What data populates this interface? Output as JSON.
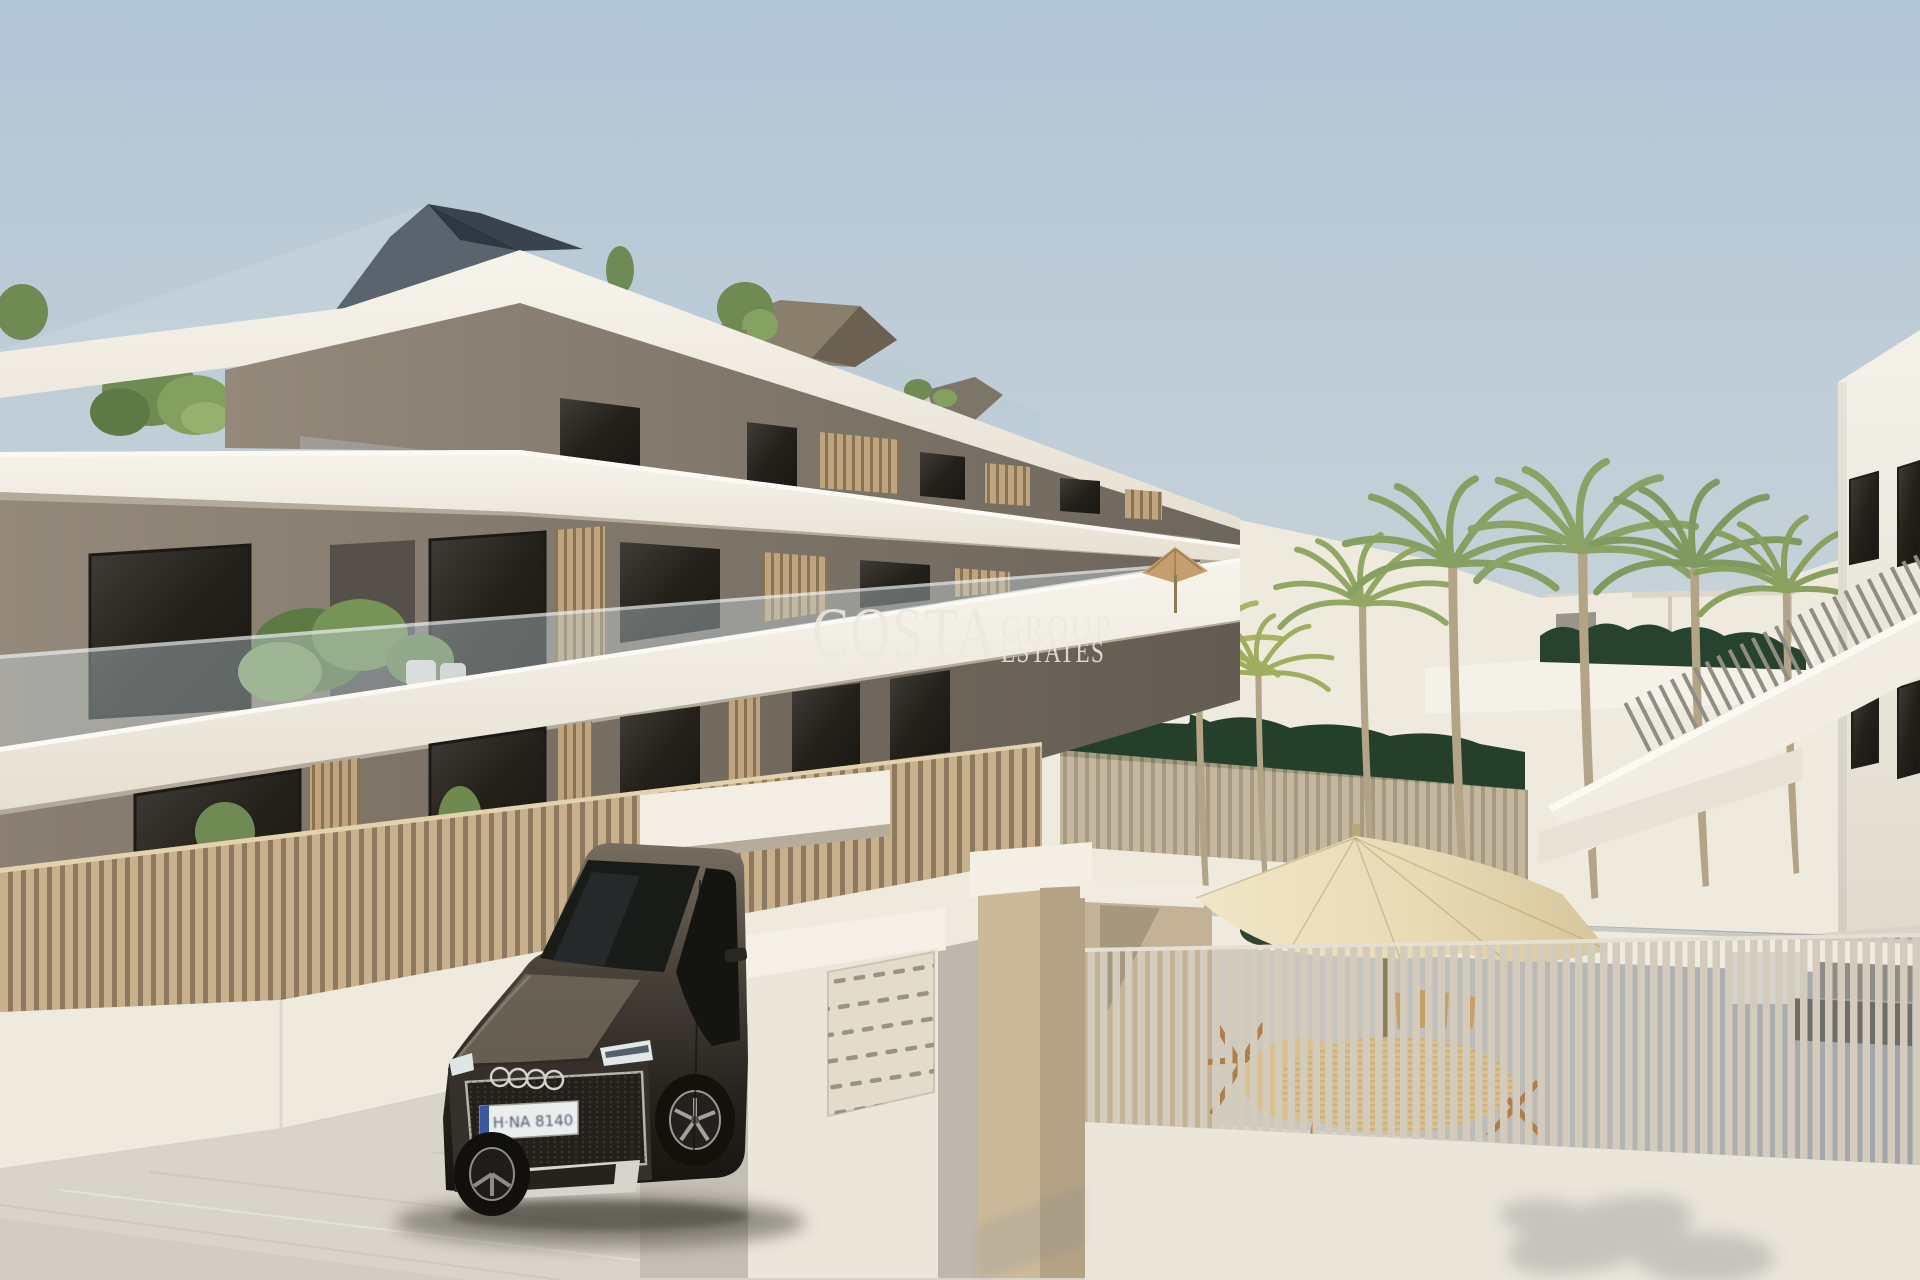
{
  "scene": {
    "type": "architectural-3d-render",
    "description": "Exterior render of a new-build three-storey apartment building with roof terraces, wooden louvre balcony screens, slatted fences, entrance gate with mailbox wall, dark SUV parked at the driveway, pool terrace with palm trees, parasols and outdoor furniture, and a white side building with an external staircase.",
    "building_floors": "3",
    "time_of_day": "daylight"
  },
  "watermark": {
    "brand": "COSTA",
    "line1": "GROUP",
    "line2": "ESTATES"
  },
  "vehicle": {
    "make_hint": "audi-rings-grille",
    "license_plate": "H·NA 8140"
  },
  "palette": {
    "sky_top": "#b2c5d5",
    "sky_horizon": "#e7e4d8",
    "slab_white": "#f4f0e6",
    "soffit": "#b3aa9a",
    "facade_light": "#94897b",
    "facade_dark": "#6e665c",
    "window_dark": "#2c2a26",
    "glass_tint": "#c3d2d8",
    "louvre": "#bfa57f",
    "fence_tan": "#c8b08c",
    "fence_tan_gap": "#8d7a5e",
    "fence_grey": "#d3cbbc",
    "wall_white": "#ebe6da",
    "wall_beige": "#c6b496",
    "pavement": "#d9d4ca",
    "hedge": "#24402b",
    "palm_green": "#86a061",
    "palm_yellow": "#a9b468",
    "trunk": "#b3a387",
    "umbrella": "#ecdfbc",
    "car_body": "#3a332b",
    "watermark": "#ece9df",
    "shadow_blue": "#7f8894"
  }
}
